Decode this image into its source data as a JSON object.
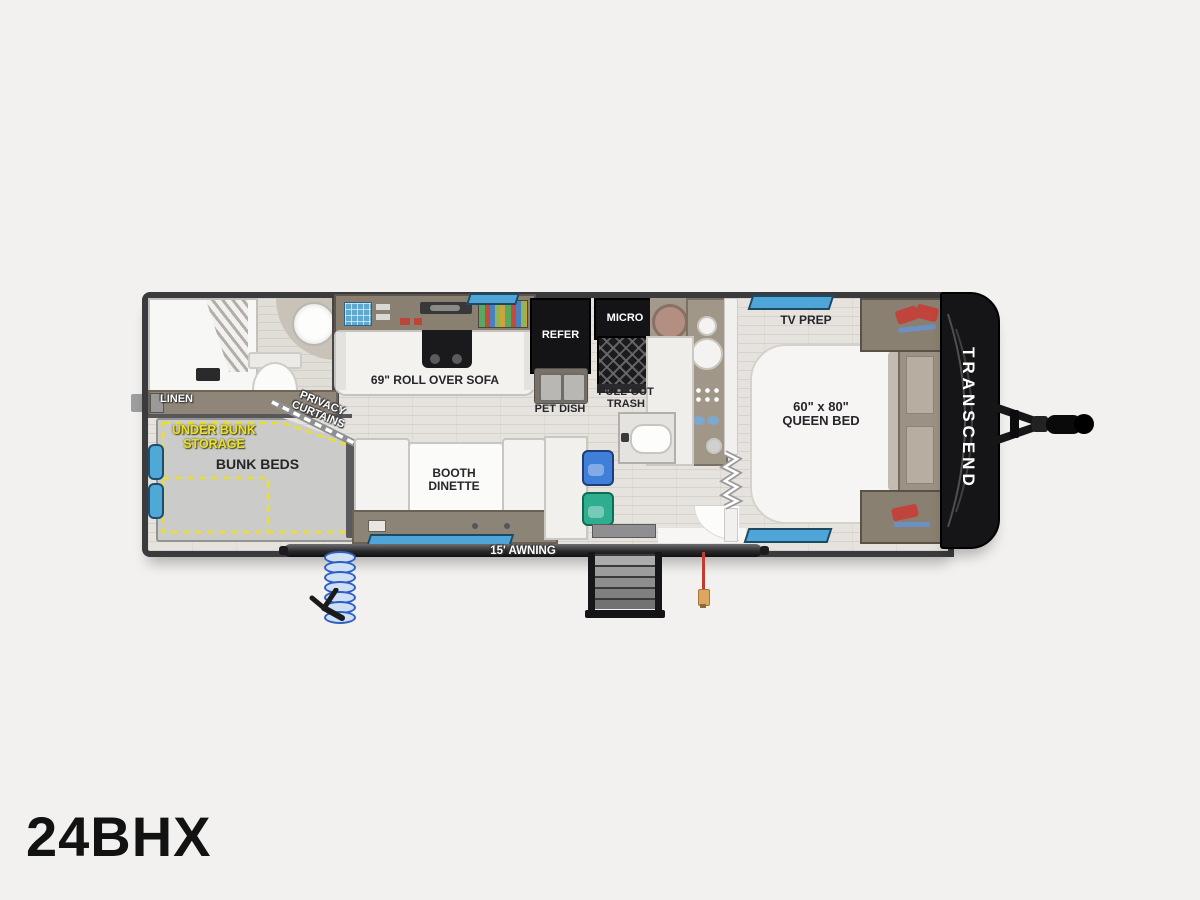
{
  "page": {
    "model": "24BHX"
  },
  "floorplan": {
    "brand": "TRANSCEND",
    "awning_label": "15' AWNING",
    "bathroom": {
      "linen_label": "LINEN",
      "privacy_curtains": {
        "line1": "PRIVACY",
        "line2": "CURTAINS"
      }
    },
    "bunks": {
      "bunk_beds_label": "BUNK BEDS",
      "under_bunk_storage": {
        "line1": "UNDER BUNK",
        "line2": "STORAGE"
      }
    },
    "living": {
      "sofa_label": "69\" ROLL OVER SOFA",
      "dinette": {
        "line1": "BOOTH",
        "line2": "DINETTE"
      }
    },
    "kitchen": {
      "refer_label": "REFER",
      "micro_label": "MICRO",
      "pet_dish_label": "PET DISH",
      "pull_out_trash": {
        "line1": "PULL-OUT",
        "line2": "TRASH"
      }
    },
    "bedroom": {
      "tv_prep_label": "TV PREP",
      "queen_bed": {
        "line1": "60\" x 80\"",
        "line2": "QUEEN BED"
      }
    }
  },
  "colors": {
    "background": "#f2f1ef",
    "wall": "#3b3b3d",
    "floor": "#e6e3de",
    "cabinet_taupe": "#9b9184",
    "accent_yellow": "#eadf2f",
    "window_blue": "#4fa5d8",
    "hose_blue": "#2f5fc4",
    "power_cord_red": "#c23a30",
    "appliance_black": "#141416",
    "chair_blue": "#3f7fd9",
    "chair_teal": "#2fae8f"
  }
}
